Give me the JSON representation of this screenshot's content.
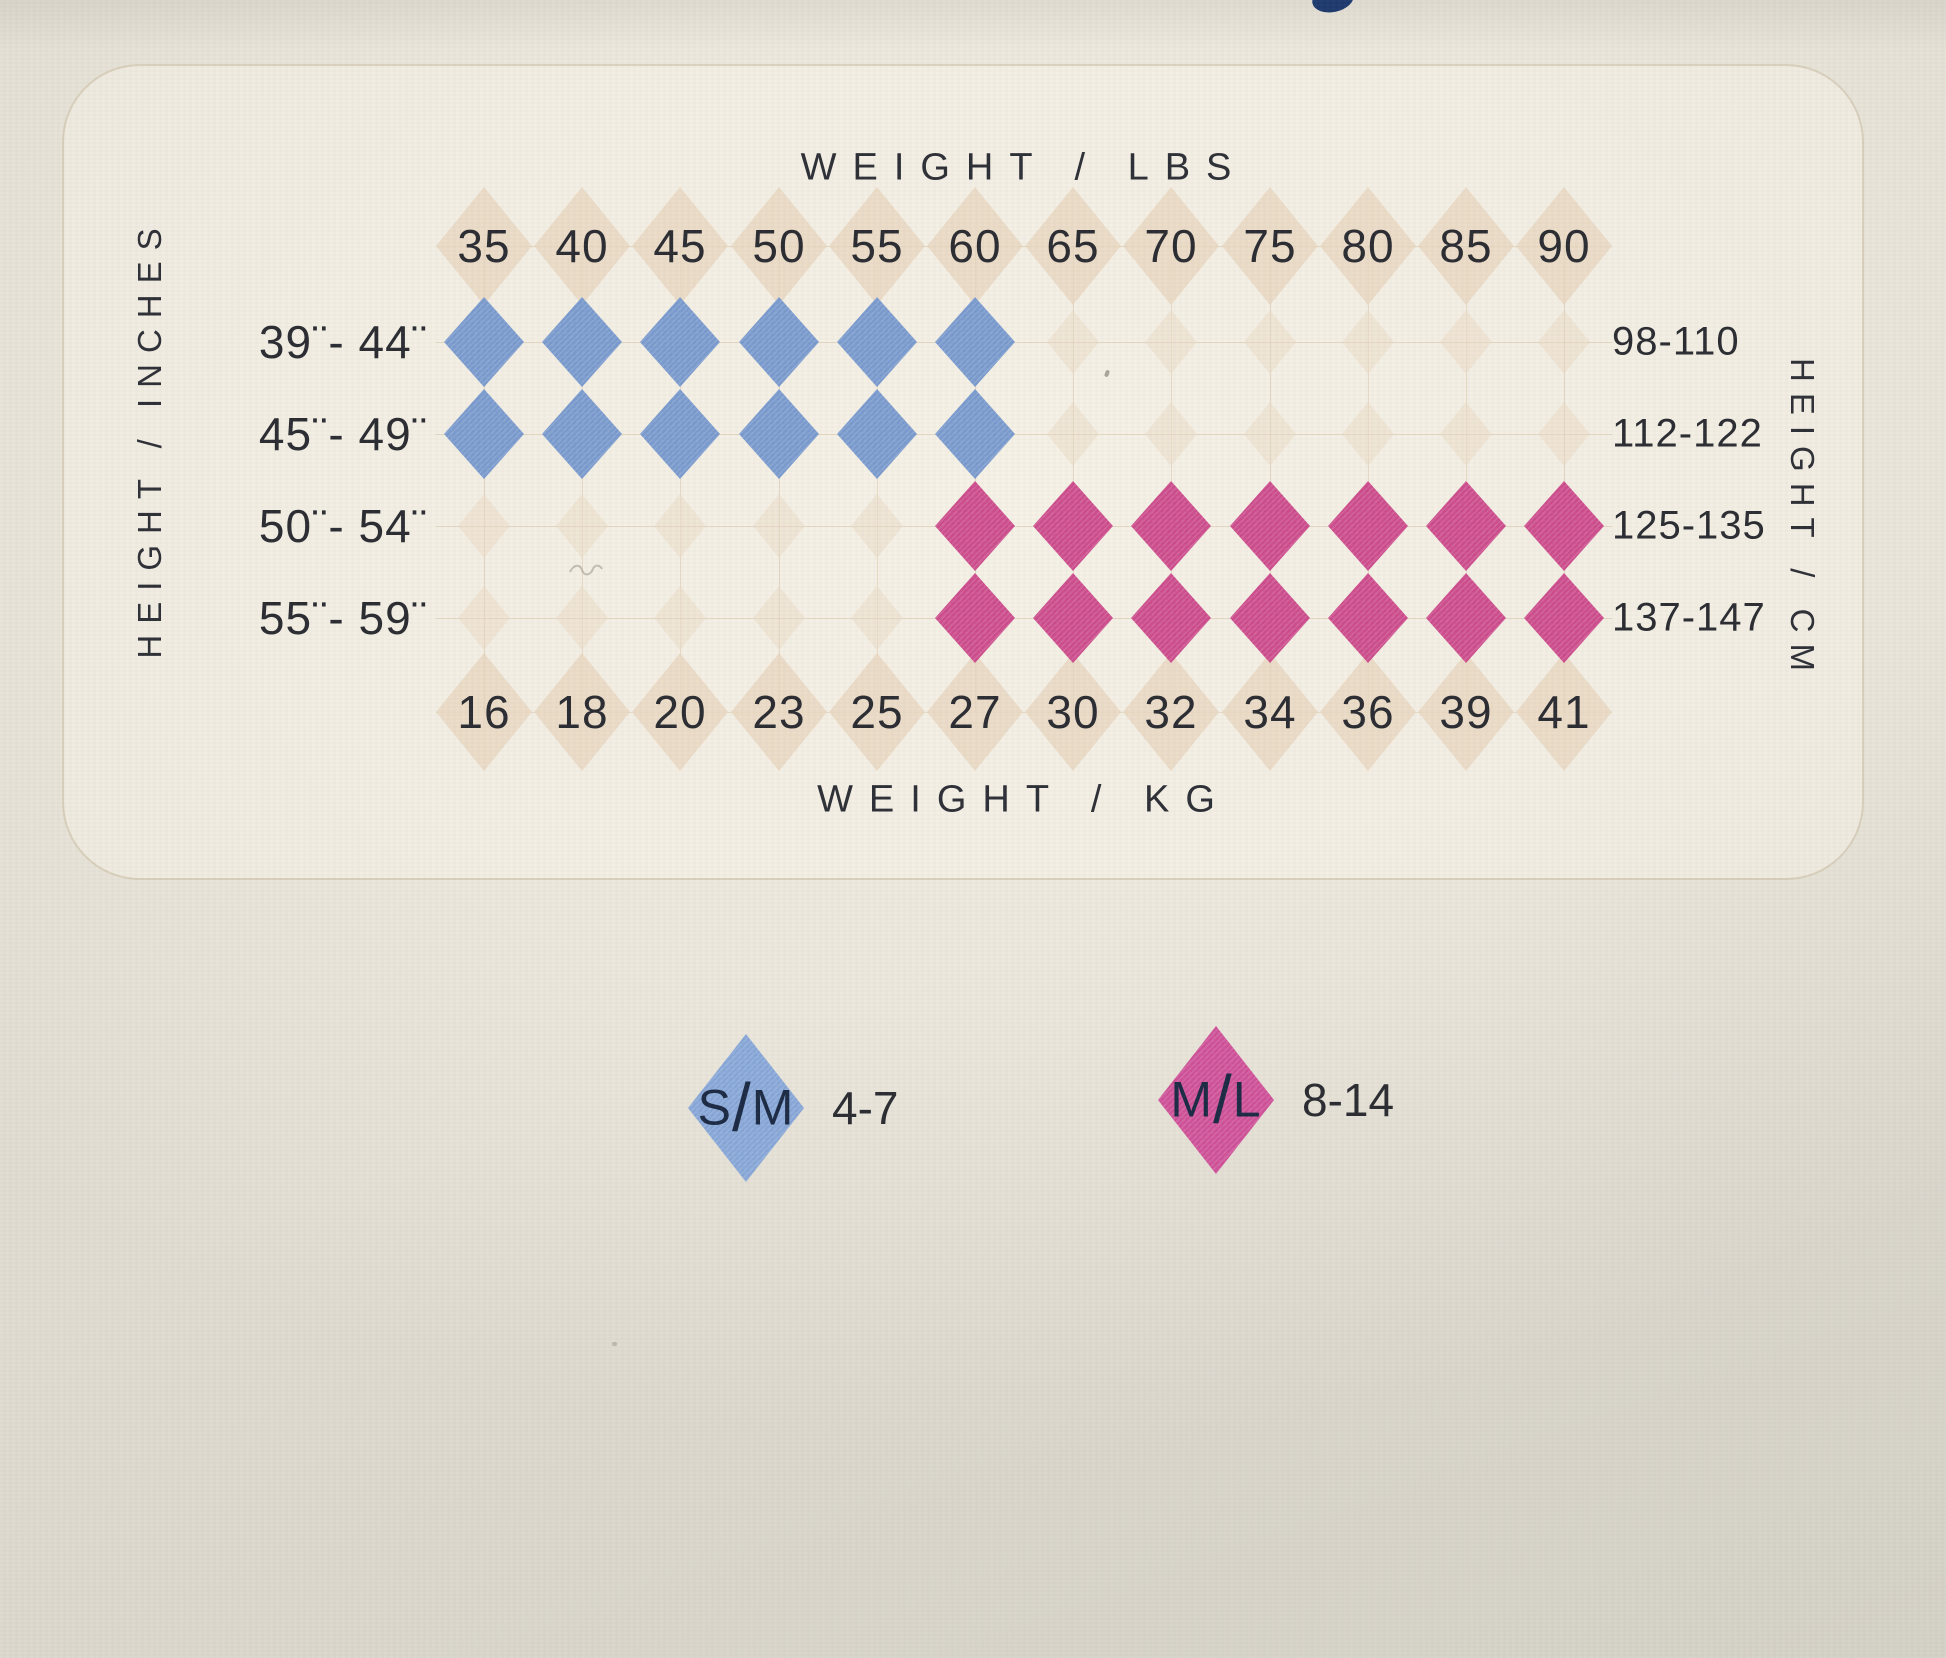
{
  "chart_data": {
    "type": "heatmap",
    "title_top": "WEIGHT / LBS",
    "title_bottom": "WEIGHT / KG",
    "axis_left": "HEIGHT / INCHES",
    "axis_right": "HEIGHT / CM",
    "columns_lbs": [
      "35",
      "40",
      "45",
      "50",
      "55",
      "60",
      "65",
      "70",
      "75",
      "80",
      "85",
      "90"
    ],
    "columns_kg": [
      "16",
      "18",
      "20",
      "23",
      "25",
      "27",
      "30",
      "32",
      "34",
      "36",
      "39",
      "41"
    ],
    "rows": [
      {
        "inches": "39¨- 44¨",
        "cm": "98-110",
        "cells": [
          "SM",
          "SM",
          "SM",
          "SM",
          "SM",
          "SM",
          null,
          null,
          null,
          null,
          null,
          null
        ]
      },
      {
        "inches": "45¨- 49¨",
        "cm": "112-122",
        "cells": [
          "SM",
          "SM",
          "SM",
          "SM",
          "SM",
          "SM",
          null,
          null,
          null,
          null,
          null,
          null
        ]
      },
      {
        "inches": "50¨- 54¨",
        "cm": "125-135",
        "cells": [
          null,
          null,
          null,
          null,
          null,
          "ML",
          "ML",
          "ML",
          "ML",
          "ML",
          "ML",
          "ML"
        ]
      },
      {
        "inches": "55¨- 59¨",
        "cm": "137-147",
        "cells": [
          null,
          null,
          null,
          null,
          null,
          "ML",
          "ML",
          "ML",
          "ML",
          "ML",
          "ML",
          "ML"
        ]
      }
    ],
    "legend": [
      {
        "code": "S/M",
        "label": "4-7",
        "color_key": "blue_legend"
      },
      {
        "code": "M/L",
        "label": "8-14",
        "color_key": "pink_legend"
      }
    ],
    "cell_legend": {
      "SM": "S/M size 4-7",
      "ML": "M/L size 8-14"
    },
    "layout_hints": {
      "grid": "argyle diamond grid",
      "legend_position": "below chart"
    }
  },
  "colors": {
    "blue": "#7a9bce",
    "pink": "#cd4d8d",
    "blue_legend": "#88a7d8",
    "pink_legend": "#cf5198",
    "beige": "#e9d7c0",
    "beige_faint": "#ecdcc6",
    "navy_text": "#1c2b45",
    "ink_blob": "#1e3a6e",
    "text": "#2b2d33"
  }
}
